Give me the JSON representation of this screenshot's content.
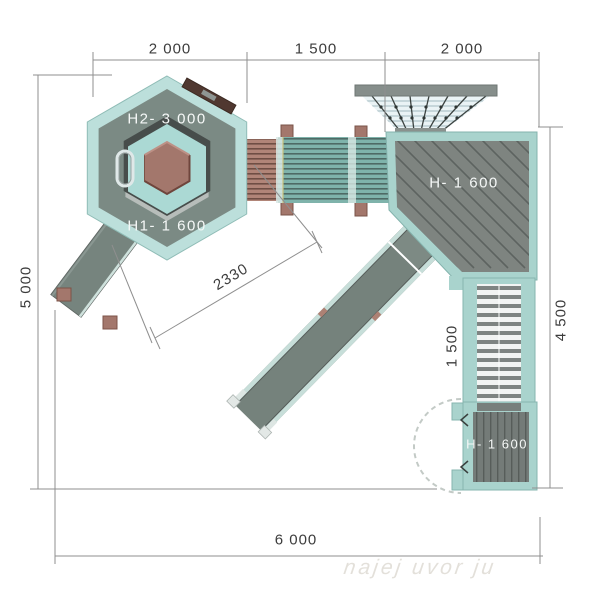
{
  "drawing": {
    "type": "playground-equipment-plan-top-view",
    "dimensions": {
      "top_left": "2 000",
      "top_mid": "1 500",
      "top_right": "2 000",
      "left": "5 000",
      "right": "4 500",
      "bottom": "6 000",
      "diagonal": "2330",
      "stairs": "1 500"
    },
    "labels": {
      "tower_upper": "H2- 3 000",
      "tower_lower": "H1- 1 600",
      "platform": "H- 1 600",
      "lower_platform": "H- 1 600"
    },
    "watermark": "najej uvor ju",
    "colors": {
      "teal_light": "#bcdfdb",
      "teal_mid": "#a9d3cd",
      "deck_gray": "#7b8a84",
      "plank_gray": "#7e8480",
      "slide_gray": "#75827c",
      "wood_brown": "#a3776c",
      "bench_brown": "#503830",
      "tube_teal": "#7fb3ab",
      "tube_brown": "#b18578",
      "dim_line": "#8f8f8f",
      "text_dark": "#3c3c3c",
      "text_light": "#f5f8f7"
    }
  }
}
